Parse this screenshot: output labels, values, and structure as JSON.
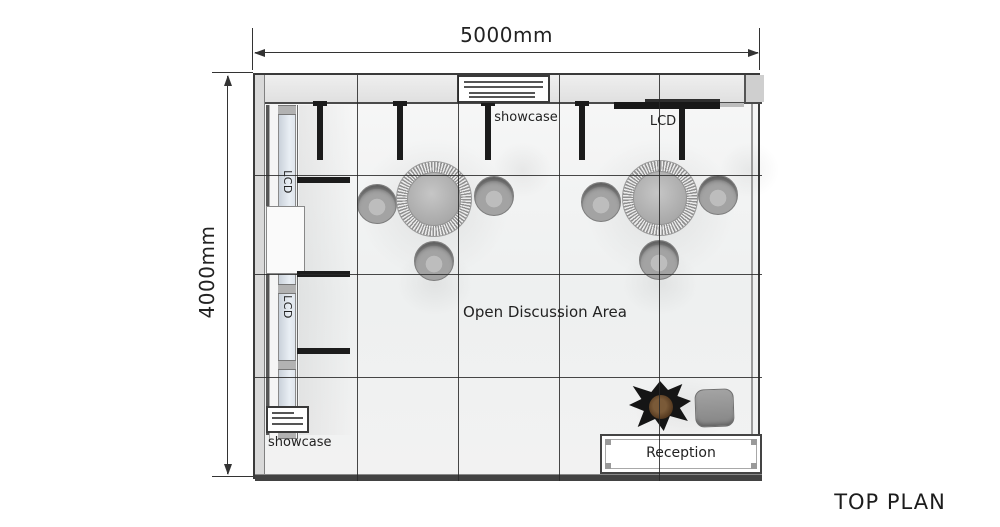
{
  "title": "TOP PLAN",
  "dimensions": {
    "width_label": "5000mm",
    "height_label": "4000mm"
  },
  "labels": {
    "showcase": "showcase",
    "lcd": "LCD",
    "open_area": "Open Discussion Area",
    "reception": "Reception"
  },
  "colors": {
    "outline": "#3a3a3a",
    "wall_fill": "#e6e6e6",
    "post_black": "#1b1b1b",
    "panel_blue": "#d5dde6",
    "furniture_gray": "#a3a3a3",
    "floor": "#f2f2f2",
    "plant_foliage": "#151515",
    "plant_pot_brown": "#55391f"
  }
}
